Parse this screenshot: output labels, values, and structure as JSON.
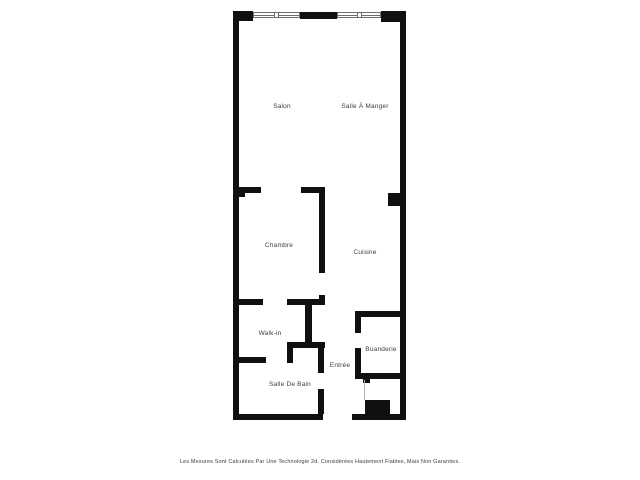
{
  "plan": {
    "wall_color": "#101010",
    "text_color": "#3d3d3d",
    "window_frame_color": "#6e6e6e",
    "door_line_color": "#b5b5b5",
    "rooms": [
      {
        "name": "salon",
        "label": "Salon",
        "x": 282,
        "y": 107
      },
      {
        "name": "salle-a-manger",
        "label": "Salle À Manger",
        "x": 365,
        "y": 107
      },
      {
        "name": "chambre",
        "label": "Chambre",
        "x": 279,
        "y": 246
      },
      {
        "name": "cuisine",
        "label": "Cuisine",
        "x": 365,
        "y": 253
      },
      {
        "name": "walk-in",
        "label": "Walk-in",
        "x": 270,
        "y": 334
      },
      {
        "name": "buanderie",
        "label": "Buanderie",
        "x": 381,
        "y": 350
      },
      {
        "name": "entree",
        "label": "Entrée",
        "x": 340,
        "y": 366
      },
      {
        "name": "salle-de-bain",
        "label": "Salle De Bain",
        "x": 290,
        "y": 385
      }
    ],
    "walls": [
      [
        233,
        12,
        6,
        408
      ],
      [
        400,
        11,
        6,
        409
      ],
      [
        233,
        11,
        20,
        10
      ],
      [
        300,
        12,
        37,
        7
      ],
      [
        381,
        11,
        25,
        11
      ],
      [
        233,
        414,
        90,
        6
      ],
      [
        352,
        414,
        54,
        6
      ],
      [
        233,
        187,
        28,
        6
      ],
      [
        301,
        187,
        24,
        6
      ],
      [
        239,
        193,
        6,
        4
      ],
      [
        319,
        193,
        6,
        80
      ],
      [
        319,
        295,
        6,
        10
      ],
      [
        388,
        193,
        12,
        13
      ],
      [
        233,
        299,
        30,
        6
      ],
      [
        287,
        299,
        38,
        6
      ],
      [
        305,
        305,
        7,
        37
      ],
      [
        287,
        342,
        38,
        6
      ],
      [
        287,
        348,
        6,
        15
      ],
      [
        233,
        357,
        33,
        6
      ],
      [
        318,
        348,
        6,
        25
      ],
      [
        318,
        389,
        6,
        25
      ],
      [
        355,
        311,
        51,
        6
      ],
      [
        355,
        311,
        6,
        22
      ],
      [
        355,
        348,
        6,
        31
      ],
      [
        355,
        373,
        51,
        6
      ],
      [
        363,
        379,
        7,
        4
      ],
      [
        365,
        400,
        25,
        14
      ]
    ],
    "windows": [
      {
        "x": 253,
        "y": 12,
        "w": 47,
        "h": 6
      },
      {
        "x": 337,
        "y": 12,
        "w": 44,
        "h": 6
      }
    ],
    "door_line": {
      "x": 364,
      "y": 380,
      "w": 1,
      "h": 20
    },
    "disclaimer": "Les Mesures Sont Calculées Par Une Technologie 2d. Considérées Hautement Fiables, Mais Non Garanties."
  }
}
